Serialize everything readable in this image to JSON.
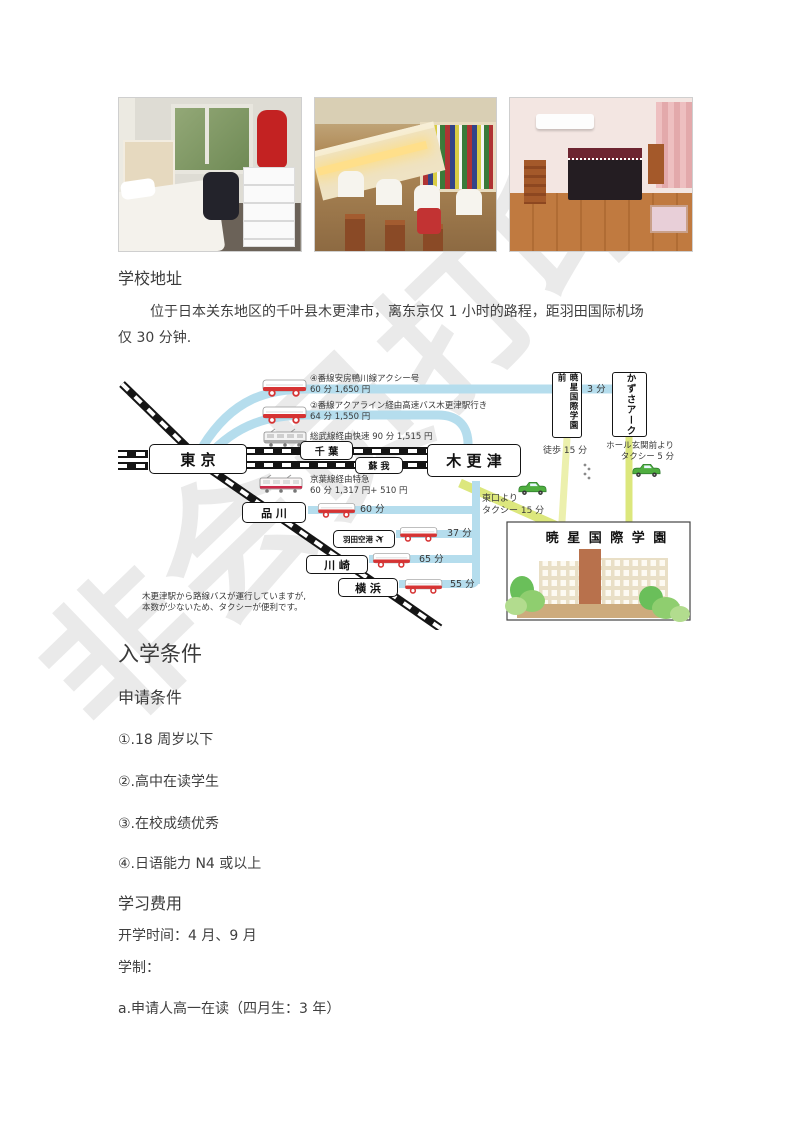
{
  "watermark": "非会员打印",
  "photos": [
    {
      "label": "dorm-room-photo"
    },
    {
      "label": "study-hall-photo"
    },
    {
      "label": "parlor-room-photo"
    }
  ],
  "address": {
    "heading": "学校地址",
    "lines": [
      "位于日本关东地区的千叶县木更津市，离东京仅 1 小时的路程，距羽田国际机场",
      "仅 30 分钟."
    ]
  },
  "map": {
    "colors": {
      "route_blue": "#b5dded",
      "road_green": "#dce77d",
      "taxi_green": "#4fae3f",
      "bus_red": "#d63333",
      "rail_black": "#151515"
    },
    "stations": {
      "tokyo": "東 京",
      "chiba": "千 葉",
      "soga": "蘇 我",
      "kisarazu": "木 更 津",
      "shinagawa": "品 川",
      "haneda": "羽田空港",
      "kawasaki": "川 崎",
      "yokohama": "横 浜"
    },
    "bus_stops": {
      "gyosei_mae": "暁星国際学園前",
      "kazusa_ark": "かずさアーク"
    },
    "labels": {
      "route_a_1": "④番線安房鴨川線アクシー号",
      "route_a_2": "60 分 1,650 円",
      "route_b_1": "②番線アクアライン経由高速バス木更津駅行き",
      "route_b_2": "64 分 1,550 円",
      "sobu": "総武線経由快速 90 分 1,515 円",
      "keiyo_1": "京葉線経由特急",
      "keiyo_2": "60 分 1,317 円+ 510 円",
      "time_shinagawa": "60 分",
      "time_haneda": "37 分",
      "time_kawasaki": "65 分",
      "time_yokohama": "55 分",
      "time_3min": "3 分",
      "walk": "徒歩 15 分",
      "hall_1": "ホール玄関前より",
      "hall_2": "タクシー 5 分",
      "east_1": "東口より",
      "east_2": "タクシー 15 分",
      "note_1": "木更津駅から路線バスが運行していますが,",
      "note_2": "本数が少ないため、タクシーが便利です。"
    },
    "school_box_title": "暁 星 国 際 学 園"
  },
  "admission": {
    "heading": "入学条件",
    "subheading": "申请条件",
    "items": [
      "①.18 周岁以下",
      "②.高中在读学生",
      "③.在校成绩优秀",
      "④.日语能力 N4 或以上"
    ]
  },
  "fees": {
    "heading": "学习费用",
    "line_start": "开学时间：4 月、9 月",
    "line_system": "学制：",
    "line_a": "a.申请人高一在读（四月生：3 年）"
  }
}
